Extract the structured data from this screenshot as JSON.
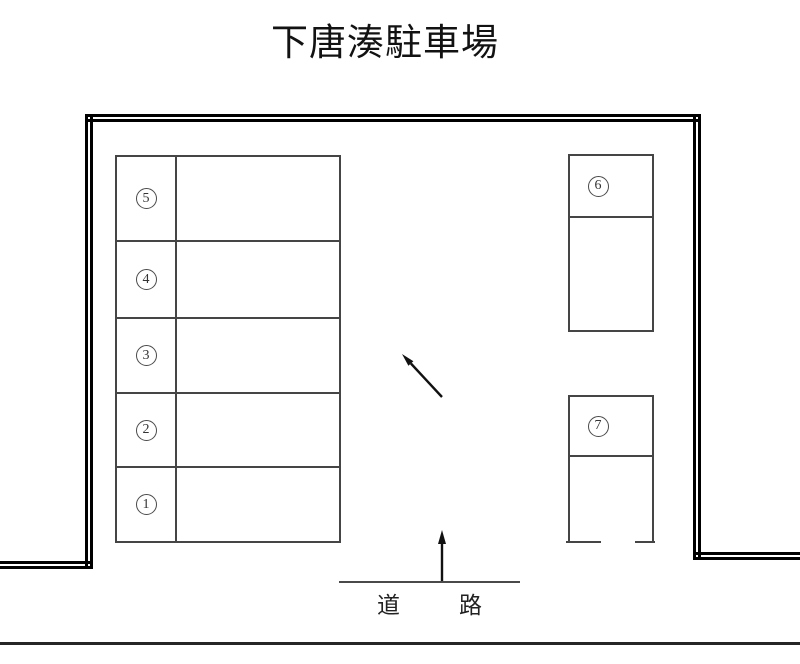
{
  "title": "下唐湊駐車場",
  "spaces": {
    "left_block": [
      {
        "number": "5",
        "unicode": "⑤"
      },
      {
        "number": "4",
        "unicode": "④"
      },
      {
        "number": "3",
        "unicode": "③"
      },
      {
        "number": "2",
        "unicode": "②"
      },
      {
        "number": "1",
        "unicode": "①"
      }
    ],
    "right_block": [
      {
        "number": "6",
        "unicode": "⑥"
      },
      {
        "number": "7",
        "unicode": "⑦"
      }
    ]
  },
  "road": {
    "left_char": "道",
    "right_char": "路"
  },
  "icons": {
    "center_arrow": "up-left-diagonal-arrow",
    "entrance_arrow": "up-arrow-from-road"
  },
  "colors": {
    "boundary": "#000000",
    "partition_line": "#454545",
    "text": "#121212"
  }
}
